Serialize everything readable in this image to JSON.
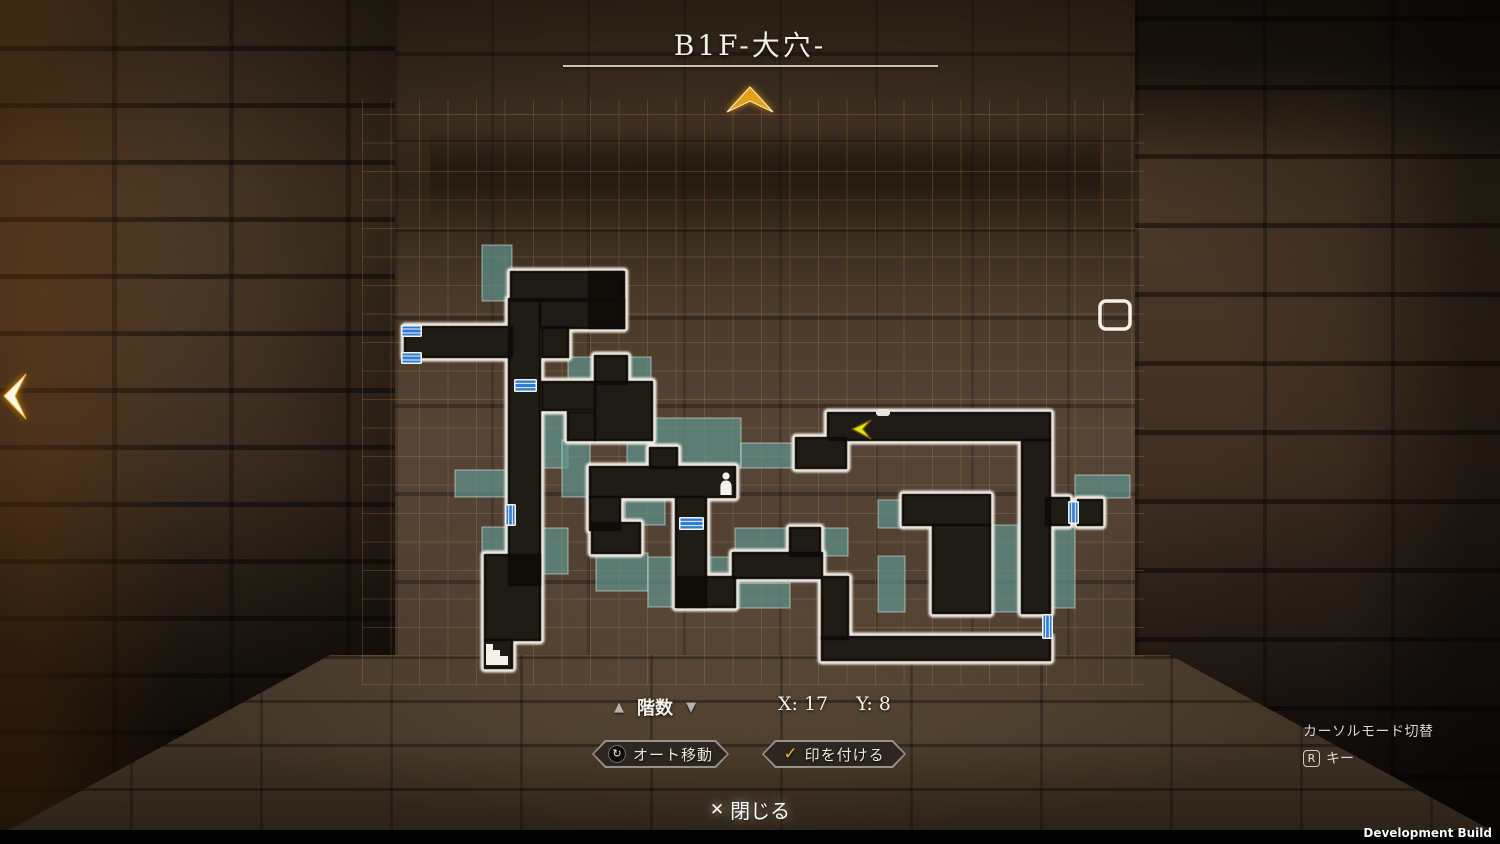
{
  "title": {
    "floor_name": "B1F-大穴-"
  },
  "hud": {
    "floor_selector": {
      "up_icon": "▲",
      "label": "階数",
      "down_icon": "▼"
    },
    "coordinates": {
      "x_value": "X: 17",
      "y_value": "Y: 8"
    },
    "auto_move_button": {
      "label": "オート移動",
      "icon": "pad-icon",
      "icon_glyph": "↻"
    },
    "mark_button": {
      "label": "印を付ける",
      "icon": "check-icon",
      "icon_glyph": "✓"
    },
    "close_button": {
      "icon_glyph": "✕",
      "label": "閉じる"
    },
    "cursor_mode_hint": {
      "label": "カーソルモード切替",
      "key": "R",
      "key_suffix": "キー"
    },
    "build_label": "Development Build"
  },
  "colors": {
    "room_teal": "rgba(97,148,143,0.70)",
    "corridor_dark": "#0f0b08",
    "wall_white": "#efece3",
    "door_blue": "#2e7cd6",
    "cursor_yellow": "#ece30a",
    "chevron_gold": "#e2a214"
  },
  "map": {
    "grid": {
      "x": 362,
      "y": 99,
      "w": 782,
      "h": 586,
      "cell": 28.5
    },
    "corridors": [
      [
        511,
        272,
        112,
        29
      ],
      [
        589,
        272,
        35,
        56
      ],
      [
        540,
        299,
        84,
        29
      ],
      [
        405,
        327,
        107,
        30
      ],
      [
        509,
        299,
        31,
        286
      ],
      [
        485,
        555,
        55,
        85
      ],
      [
        485,
        640,
        27,
        28
      ],
      [
        542,
        382,
        53,
        28
      ],
      [
        595,
        356,
        32,
        28
      ],
      [
        542,
        327,
        26,
        30
      ],
      [
        595,
        382,
        57,
        58
      ],
      [
        568,
        412,
        27,
        28
      ],
      [
        650,
        448,
        27,
        20
      ],
      [
        590,
        467,
        145,
        30
      ],
      [
        590,
        497,
        30,
        33
      ],
      [
        592,
        523,
        48,
        30
      ],
      [
        676,
        497,
        30,
        110
      ],
      [
        678,
        577,
        57,
        30
      ],
      [
        733,
        553,
        89,
        25
      ],
      [
        822,
        577,
        26,
        62
      ],
      [
        822,
        637,
        228,
        23
      ],
      [
        796,
        438,
        50,
        30
      ],
      [
        828,
        413,
        222,
        27
      ],
      [
        1022,
        440,
        28,
        173
      ],
      [
        903,
        495,
        87,
        30
      ],
      [
        933,
        525,
        57,
        88
      ],
      [
        1046,
        498,
        23,
        27
      ],
      [
        1078,
        500,
        24,
        25
      ],
      [
        790,
        528,
        30,
        28
      ]
    ],
    "rooms": [
      [
        482,
        245,
        30,
        56
      ],
      [
        568,
        357,
        27,
        26
      ],
      [
        627,
        357,
        24,
        26
      ],
      [
        627,
        418,
        114,
        50
      ],
      [
        741,
        443,
        55,
        25
      ],
      [
        542,
        412,
        26,
        56
      ],
      [
        562,
        440,
        28,
        57
      ],
      [
        455,
        470,
        55,
        27
      ],
      [
        482,
        527,
        30,
        26
      ],
      [
        540,
        528,
        28,
        46
      ],
      [
        625,
        499,
        40,
        26
      ],
      [
        596,
        553,
        52,
        38
      ],
      [
        648,
        557,
        30,
        50
      ],
      [
        708,
        557,
        27,
        26
      ],
      [
        735,
        583,
        55,
        25
      ],
      [
        735,
        528,
        55,
        28
      ],
      [
        820,
        528,
        28,
        28
      ],
      [
        878,
        500,
        27,
        28
      ],
      [
        878,
        556,
        27,
        56
      ],
      [
        990,
        525,
        28,
        87
      ],
      [
        1047,
        527,
        28,
        81
      ],
      [
        1075,
        475,
        55,
        23
      ]
    ],
    "doors": [
      [
        401,
        325,
        21,
        12,
        "h"
      ],
      [
        401,
        352,
        21,
        12,
        "h"
      ],
      [
        514,
        379,
        23,
        13,
        "h"
      ],
      [
        679,
        517,
        25,
        13,
        "h"
      ],
      [
        505,
        504,
        11,
        22,
        "v"
      ],
      [
        1068,
        501,
        11,
        23,
        "v"
      ],
      [
        1042,
        614,
        11,
        25,
        "v"
      ]
    ],
    "player": {
      "x": 726,
      "y": 476
    },
    "cursor": {
      "points": "871,420 852,429 871,439 863,429"
    },
    "target_box": [
      1100,
      301,
      30,
      28
    ],
    "stairs": {
      "x": 486,
      "y": 644
    },
    "wall_nub": [
      876,
      409,
      14,
      7
    ],
    "chevron_top": {
      "points": "727,112 750,87 773,112 750,101"
    },
    "chevron_left": {
      "points": "26,374 4,396 26,419 15,396"
    }
  }
}
